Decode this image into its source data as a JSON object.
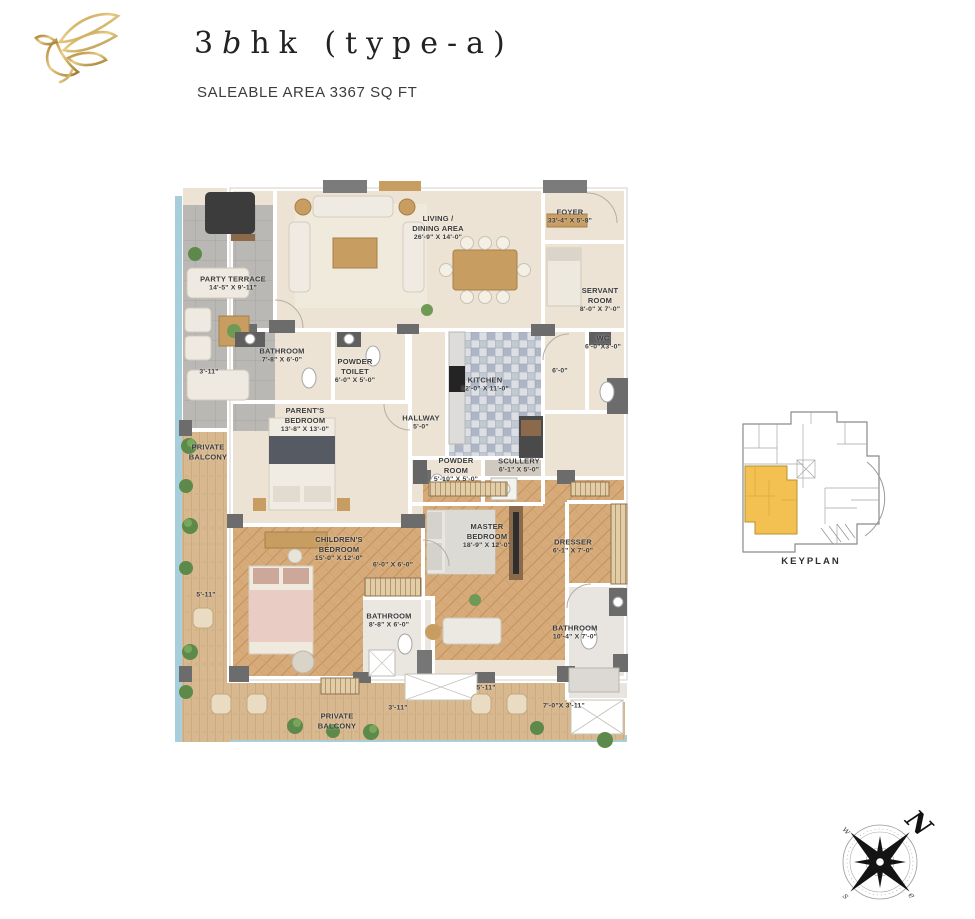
{
  "header": {
    "title_prefix": "3",
    "title_italic": "b",
    "title_rest": "hk (type-a)",
    "subtitle": "SALEABLE AREA 3367 SQ FT",
    "brand_color": "#C9A24B"
  },
  "plan": {
    "rooms": [
      {
        "lines": [
          "PARTY TERRACE"
        ],
        "dims": "14'-5\" X 9'-11\""
      },
      {
        "lines": [
          "LIVING /",
          "DINING AREA"
        ],
        "dims": "26'-9\" X 14'-0\""
      },
      {
        "lines": [
          "FOYER"
        ],
        "dims": "33'-4\" X 5'-8\""
      },
      {
        "lines": [
          "SERVANT",
          "ROOM"
        ],
        "dims": "8'-0\" X 7'-0\""
      },
      {
        "lines": [
          "WC"
        ],
        "dims": "6'-0\"X3'-0\""
      },
      {
        "lines": [
          "BATHROOM"
        ],
        "dims": "7'-8\" X 6'-0\""
      },
      {
        "lines": [
          "POWDER",
          "TOILET"
        ],
        "dims": "6'-0\" X 5'-0\""
      },
      {
        "lines": [
          "PARENT'S",
          "BEDROOM"
        ],
        "dims": "13'-8\" X 13'-0\""
      },
      {
        "lines": [
          "HALLWAY"
        ],
        "dims": "5'-0\""
      },
      {
        "lines": [
          "KITCHEN"
        ],
        "dims": "12'-0\" X 11'-0\""
      },
      {
        "lines": [
          "POWDER",
          "ROOM"
        ],
        "dims": "5'-10\" X 5'-0\""
      },
      {
        "lines": [
          "SCULLERY"
        ],
        "dims": "6'-1\" X 5'-0\""
      },
      {
        "lines": [
          "CHILDREN'S",
          "BEDROOM"
        ],
        "dims": "15'-0\" X 12'-0\""
      },
      {
        "lines": [
          "MASTER",
          "BEDROOM"
        ],
        "dims": "18'-9\" X 12'-0\""
      },
      {
        "lines": [
          "DRESSER"
        ],
        "dims": "6'-1\" X 7'-0\""
      },
      {
        "lines": [
          "BATHROOM"
        ],
        "dims": "8'-8\" X 6'-0\""
      },
      {
        "lines": [
          "BATHROOM"
        ],
        "dims": "10'-4\" X 7'-0\""
      },
      {
        "lines": [
          "PRIVATE",
          "BALCONY"
        ],
        "dims": ""
      },
      {
        "lines": [
          "PRIVATE",
          "BALCONY"
        ],
        "dims": ""
      }
    ],
    "dimension_marks": [
      "3'-11\"",
      "5'-11\"",
      "6'-0\"",
      "6'-0\" X 6'-0\"",
      "3'-11\"",
      "5'-11\"",
      "7'-0\"X 3'-11\""
    ]
  },
  "keyplan": {
    "label": "KEYPLAN",
    "highlight_color": "#F2C151"
  },
  "compass": {
    "north": "N",
    "west": "w",
    "south": "s",
    "east": "e"
  }
}
